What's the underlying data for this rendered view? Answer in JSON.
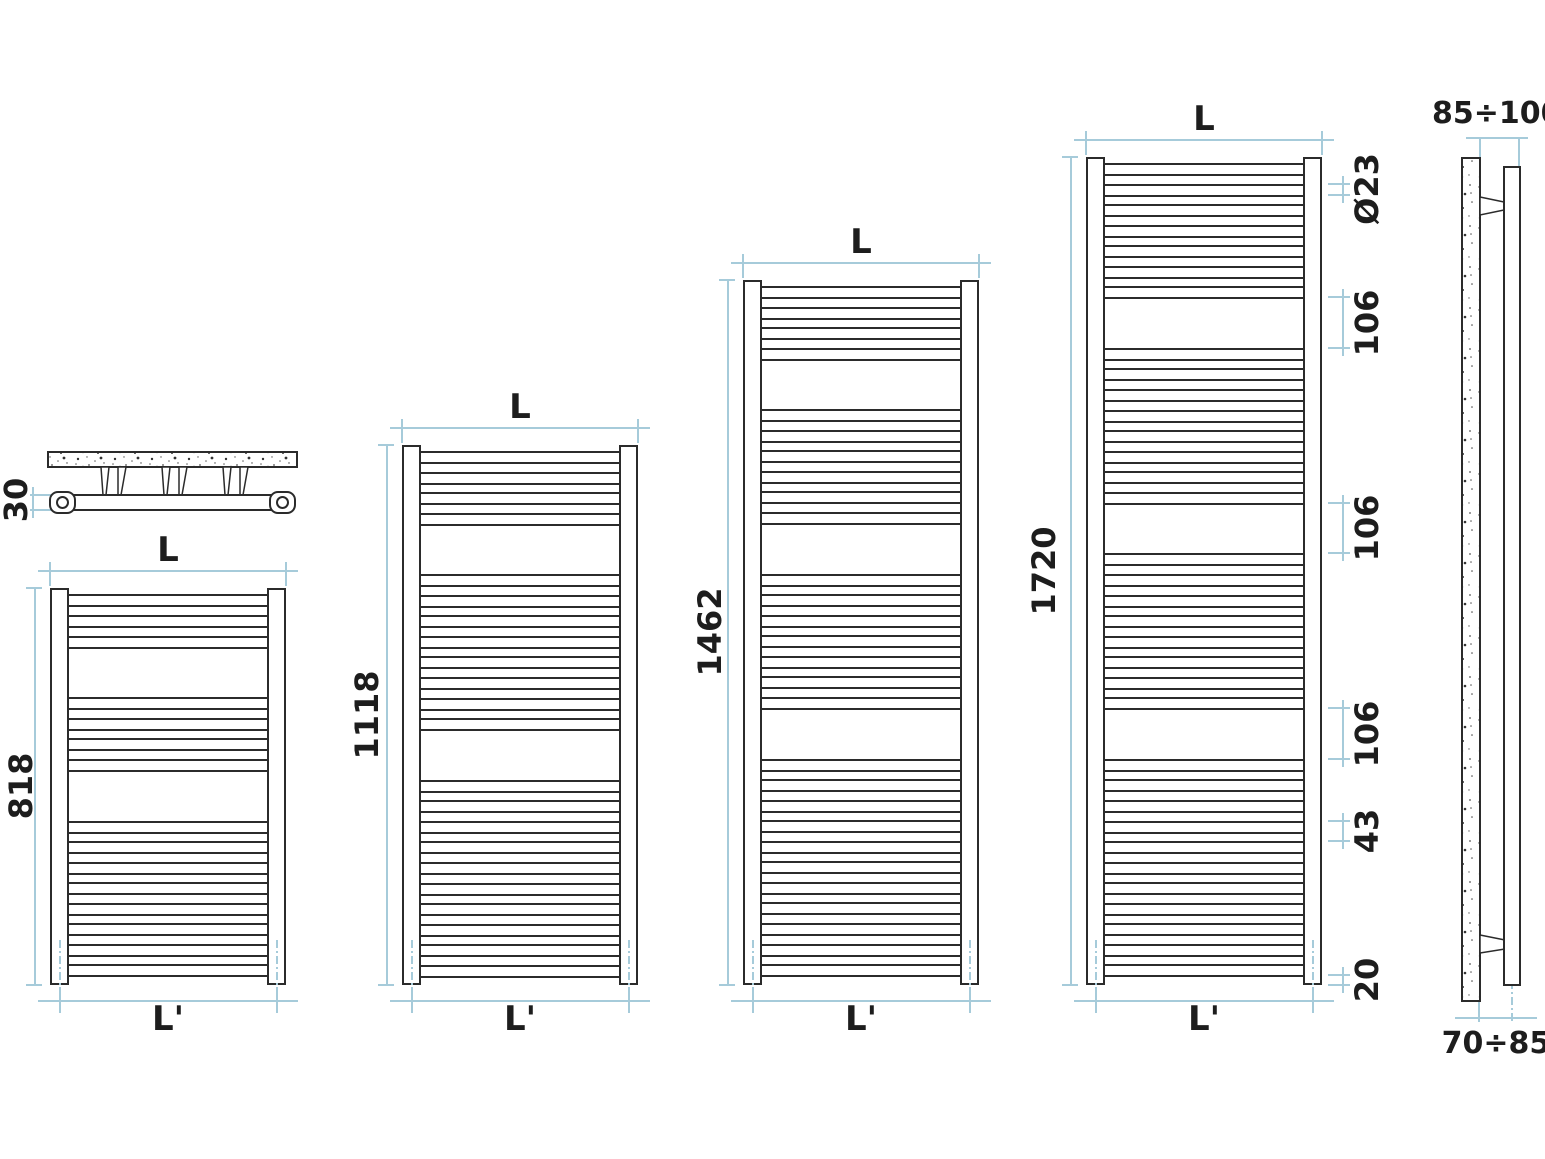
{
  "drawing": {
    "background": "#ffffff",
    "line_color": "#2b2b2b",
    "dimension_color": "#a6cbda",
    "text_color": "#1d1d1d"
  },
  "plan_view": {
    "depth_label": "30"
  },
  "side_view": {
    "wall_to_front_label": "85÷100",
    "wall_to_axis_label": "70÷85"
  },
  "radiators": [
    {
      "height_label": "818",
      "height_mm": 818,
      "width_label": "L",
      "base_width_label": "L'",
      "tube_groups": [
        3,
        4,
        8
      ]
    },
    {
      "height_label": "1118",
      "height_mm": 1118,
      "width_label": "L",
      "base_width_label": "L'",
      "tube_groups": [
        4,
        8,
        10
      ]
    },
    {
      "height_label": "1462",
      "height_mm": 1462,
      "width_label": "L",
      "base_width_label": "L'",
      "tube_groups": [
        4,
        6,
        7,
        11
      ]
    },
    {
      "height_label": "1720",
      "height_mm": 1720,
      "width_label": "L",
      "base_width_label": "L'",
      "tube_groups": [
        7,
        8,
        8,
        11
      ]
    }
  ],
  "detail_dims": {
    "tube_diameter": "Ø23",
    "group_gap_1": "106",
    "group_gap_2": "106",
    "group_gap_3": "106",
    "tube_pitch": "43",
    "bottom_offset": "20"
  },
  "spec": {
    "tube_diameter_mm": 23,
    "tube_pitch_mm": 43,
    "group_gap_mm": 106,
    "bottom_offset_mm": 20
  }
}
